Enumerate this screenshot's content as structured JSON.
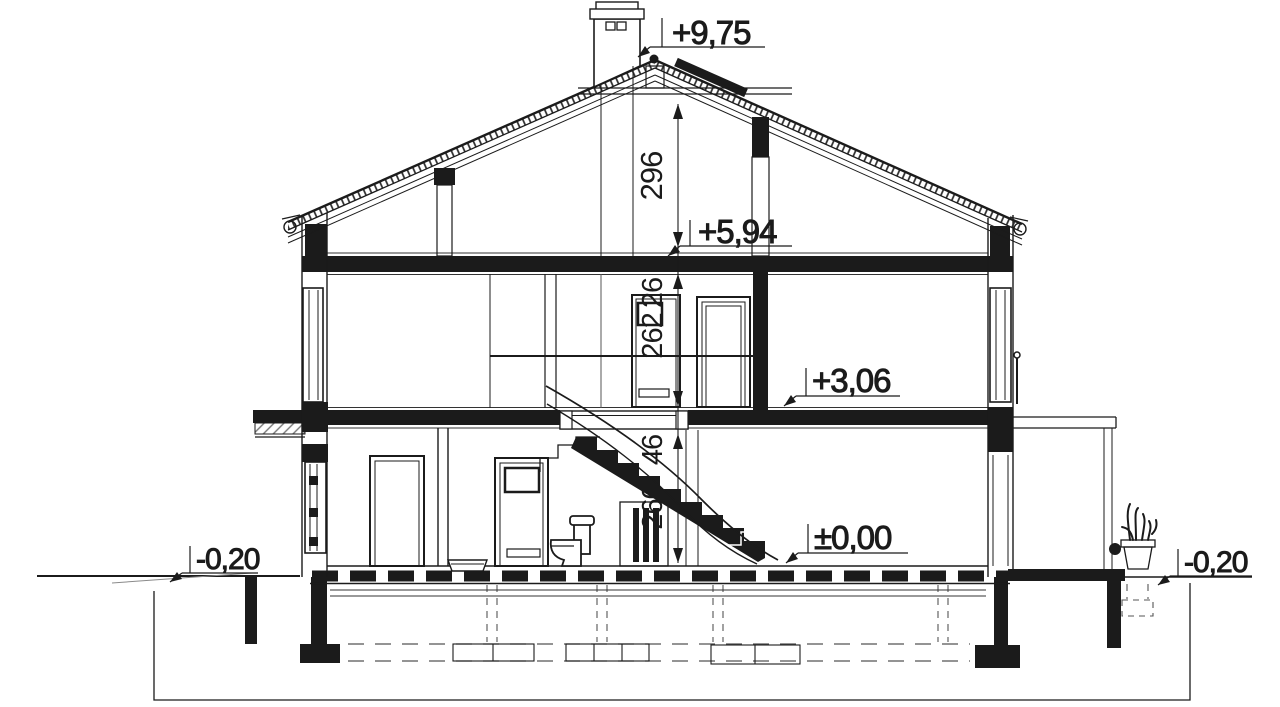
{
  "colors": {
    "ink": "#1b1b1b",
    "paper": "#ffffff"
  },
  "levels": {
    "ridge": "+9,75",
    "attic_floor": "+5,94",
    "first_floor": "+3,06",
    "ground_floor": "±0,00",
    "grade_left": "-0,20",
    "grade_right": "-0,20"
  },
  "dimensions": {
    "attic_height_to_collar": "296",
    "upper_floor_slab": "26",
    "upper_room_height": "262",
    "ground_floor_slab": "46",
    "ground_room_height": "260"
  }
}
